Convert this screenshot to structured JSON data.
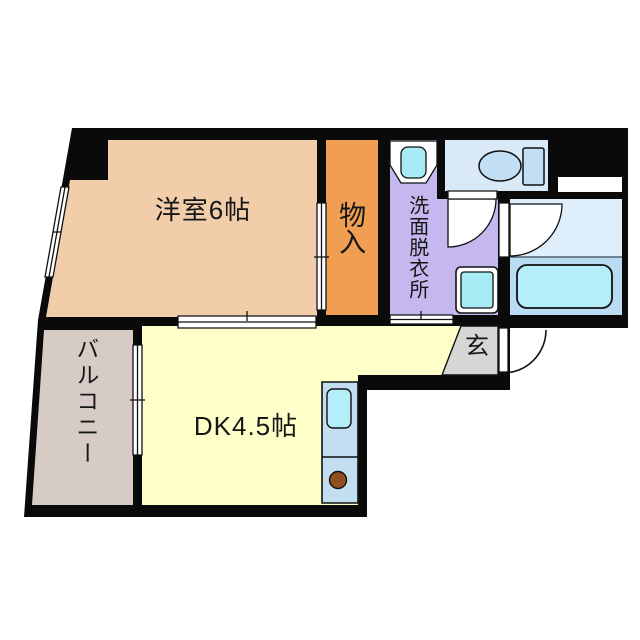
{
  "title": "1DK apartment floor plan",
  "rooms": {
    "yoshitsu": {
      "label": "洋室6帖",
      "size_tatami": 6
    },
    "monoire": {
      "label": "物入"
    },
    "senmen": {
      "label": "洗面脱衣所"
    },
    "genkan": {
      "label": "玄"
    },
    "dk": {
      "label": "DK4.5帖",
      "size_tatami": 4.5
    },
    "balcony": {
      "label": "バルコニー"
    },
    "toilet_room": {
      "label": ""
    },
    "bathroom": {
      "label": ""
    }
  },
  "fixtures": [
    "toilet",
    "toilet-tank",
    "bathtub",
    "wash-basin-counter",
    "wash-basin",
    "washing-machine-pan",
    "kitchen-counter",
    "kitchen-sink",
    "stove-burner",
    "entrance-door-swing",
    "bath-door-swing",
    "toilet-door-swing",
    "sliding-window-west",
    "sliding-door-dk",
    "sliding-door-balcony",
    "sliding-door-closet",
    "sliding-door-washroom"
  ],
  "colors": {
    "wall": "#0a0a0a",
    "yoshitsu": "#f2cda9",
    "monoire": "#ef9e52",
    "senmen": "#c4b8ee",
    "toilet_room": "#d9e9f8",
    "bath_upper": "#dfeefb",
    "bath_lower": "#badcf3",
    "tub": "#b4eef8",
    "cyan_fixture": "#a9ebf5",
    "dk": "#ffffc9",
    "genkan": "#d6d6d6",
    "balcony": "#d6ccc5",
    "kitchen": "#c3def1",
    "burner": "#8e5020",
    "fixture_fill": "#c2def5",
    "line": "#111111"
  }
}
